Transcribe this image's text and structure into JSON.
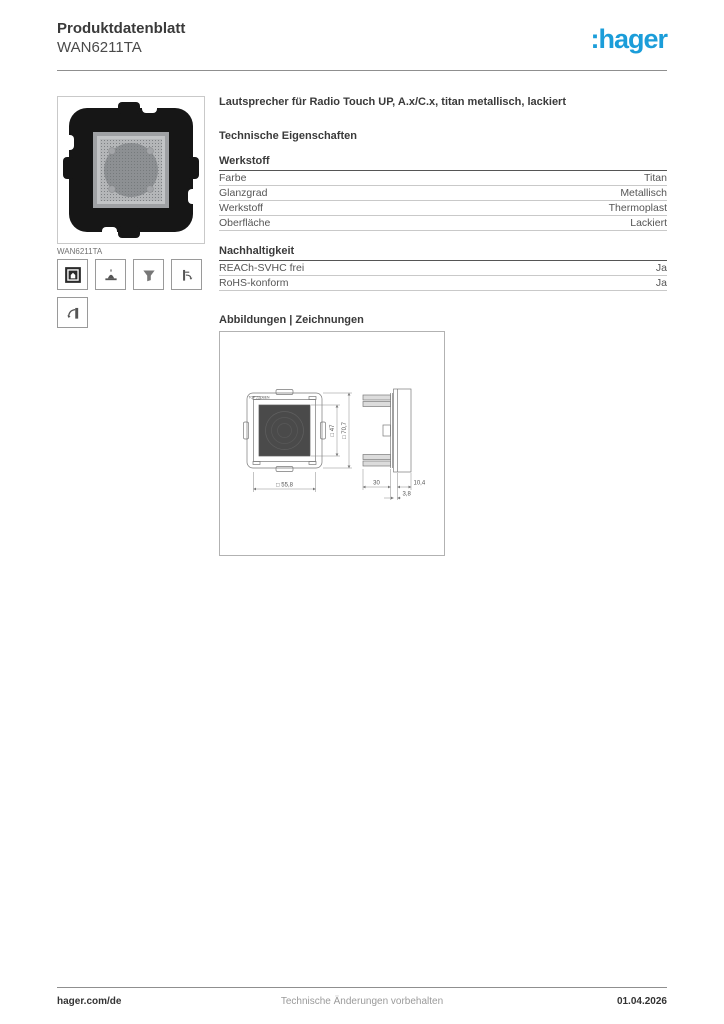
{
  "header": {
    "doc_type": "Produktdatenblatt",
    "product_ref": "WAN6211TA",
    "brand_logo": ":hager",
    "brand_color": "#1b9dd9"
  },
  "product": {
    "title": "Lautsprecher für Radio Touch UP, A.x/C.x, titan metallisch, lackiert",
    "image_caption": "WAN6211TA",
    "icons": [
      "flush-mount-icon",
      "claw-fixing-icon",
      "funnel-icon",
      "speaker-direction-icon",
      "horn-speaker-icon"
    ]
  },
  "sections": {
    "tech_heading": "Technische Eigenschaften",
    "groups": [
      {
        "heading": "Werkstoff",
        "rows": [
          {
            "label": "Farbe",
            "value": "Titan"
          },
          {
            "label": "Glanzgrad",
            "value": "Metallisch"
          },
          {
            "label": "Werkstoff",
            "value": "Thermoplast"
          },
          {
            "label": "Oberfläche",
            "value": "Lackiert"
          }
        ]
      },
      {
        "heading": "Nachhaltigkeit",
        "rows": [
          {
            "label": "REACh-SVHC frei",
            "value": "Ja"
          },
          {
            "label": "RoHS-konform",
            "value": "Ja"
          }
        ]
      }
    ],
    "drawings_heading": "Abbildungen | Zeichnungen"
  },
  "drawing": {
    "orientation_label": "TOP △ OBEN",
    "dims": {
      "front_width": "□ 55,8",
      "inner_square": "□ 47",
      "outer_square": "□ 70,7",
      "depth": "30",
      "frame_depth": "10,4",
      "offset": "3,8"
    }
  },
  "footer": {
    "website": "hager.com/de",
    "note": "Technische Änderungen vorbehalten",
    "date": "01.04.2026"
  }
}
